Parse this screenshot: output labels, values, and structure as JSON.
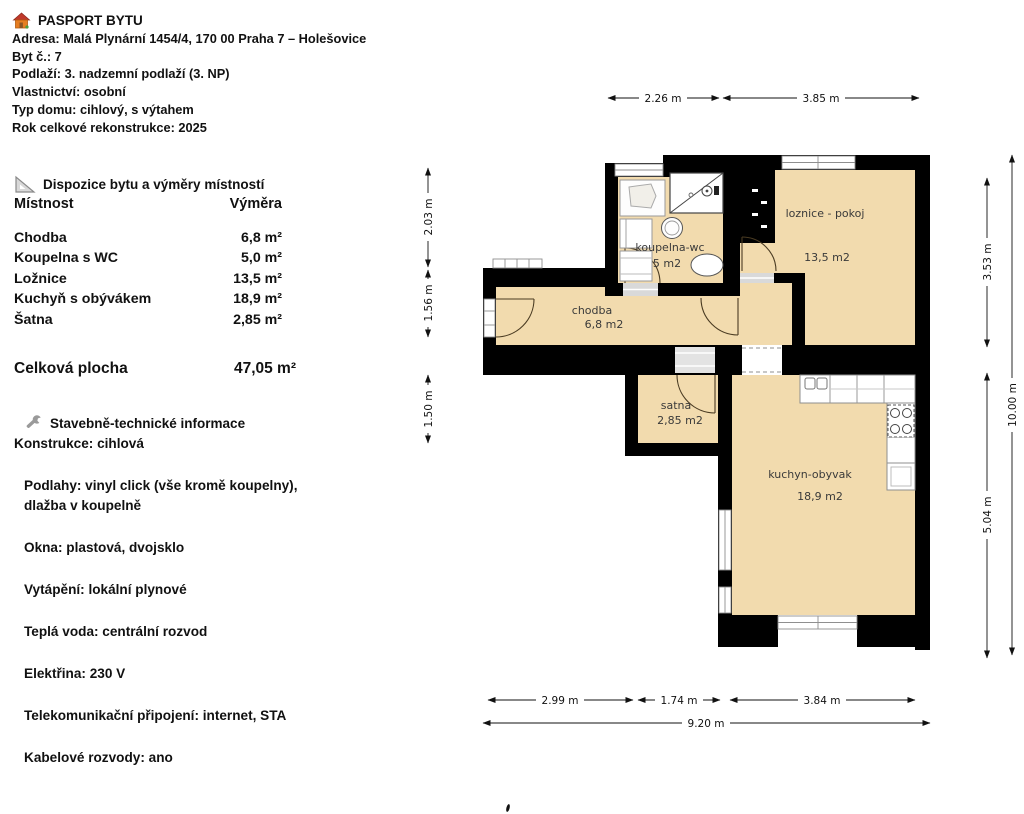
{
  "colors": {
    "room_fill": "#f2dbae",
    "wall": "#000000",
    "window_stroke": "#8f8f8f",
    "text": "#111111"
  },
  "icons": {
    "header_icon": "house-icon",
    "rooms_icon": "set-square-icon",
    "tech_icon": "wrench-icon"
  },
  "header": {
    "title": "PASPORT BYTU",
    "address": "Adresa: Malá Plynární 1454/4, 170 00 Praha 7 – Holešovice",
    "unit": "Byt č.: 7",
    "floor": "Podlaží: 3. nadzemní podlaží (3. NP)",
    "ownership": "Vlastnictví: osobní",
    "building_type": "Typ domu: cihlový, s výtahem",
    "reconstruction": "Rok celkové rekonstrukce: 2025"
  },
  "rooms_table": {
    "title": "Dispozice bytu a výměry místností",
    "col_room": "Místnost",
    "col_area": "Výměra",
    "rows": [
      {
        "label": "Chodba",
        "area": "6,8 m²"
      },
      {
        "label": "Koupelna s WC",
        "area": "5,0 m²"
      },
      {
        "label": "Ložnice",
        "area": "13,5 m²"
      },
      {
        "label": "Kuchyň s obývákem",
        "area": "18,9 m²"
      },
      {
        "label": "Šatna",
        "area": "2,85 m²"
      }
    ],
    "total_label": "Celková plocha",
    "total_area": "47,05 m²"
  },
  "tech": {
    "title": "Stavebně-technické informace",
    "lines": [
      "Konstrukce: cihlová",
      "Podlahy: vinyl click (vše kromě koupelny),\ndlažba v koupelně",
      "Okna: plastová, dvojsklo",
      "Vytápění: lokální plynové",
      "Teplá voda: centrální rozvod",
      "Elektřina: 230 V",
      "Telekomunikační připojení: internet, STA",
      "Kabelové rozvody: ano"
    ]
  },
  "floorplan": {
    "rooms": [
      {
        "name": "koupelna-wc",
        "area": "5 m2"
      },
      {
        "name": "loznice - pokoj",
        "area": "13,5 m2"
      },
      {
        "name": "chodba",
        "area": "6,8 m2"
      },
      {
        "name": "satna",
        "area": "2,85 m2"
      },
      {
        "name": "kuchyn-obyvak",
        "area": "18,9 m2"
      }
    ],
    "dims": {
      "top": [
        "2.26 m",
        "3.85 m"
      ],
      "left": [
        "2.03 m",
        "1.56 m",
        "1.50 m"
      ],
      "right": [
        "3.53 m",
        "5.04 m",
        "10.00 m"
      ],
      "bottom": [
        "2.99 m",
        "1.74 m",
        "3.84 m",
        "9.20 m"
      ]
    }
  }
}
